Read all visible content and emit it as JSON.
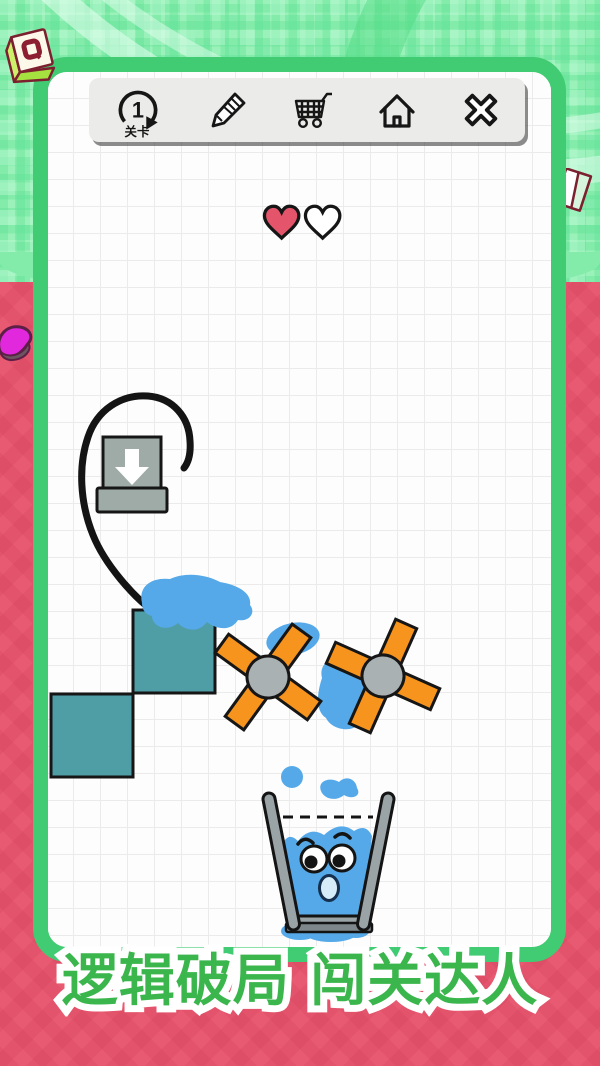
{
  "toolbar": {
    "level": {
      "number": "1",
      "label": "关卡"
    },
    "icons": [
      {
        "name": "level-restart-icon",
        "glyph": "circular-arrow"
      },
      {
        "name": "pencil-icon",
        "glyph": "pencil"
      },
      {
        "name": "shop-cart-icon",
        "glyph": "shopping-cart"
      },
      {
        "name": "home-icon",
        "glyph": "house"
      },
      {
        "name": "close-icon",
        "glyph": "cross"
      }
    ]
  },
  "lives": {
    "filled": 1,
    "total": 2
  },
  "banner": {
    "text": "逻辑破局 闯关达人"
  },
  "game_objects": [
    {
      "name": "ink-line",
      "type": "player-drawn-line"
    },
    {
      "name": "water-dispenser",
      "type": "spout-with-down-arrow"
    },
    {
      "name": "teal-block",
      "count": 2
    },
    {
      "name": "pinwheel",
      "count": 2
    },
    {
      "name": "water-splash",
      "count": 6
    },
    {
      "name": "glass-character",
      "expression": "surprised",
      "fill_marker": "dashed-line"
    }
  ],
  "colors": {
    "bg_green": "#84ecaa",
    "bg_pink": "#e85a71",
    "frame_green": "#41cc73",
    "banner_green": "#3bb64d",
    "ui_gray": "#ebebe9",
    "water_blue": "#55a9e8",
    "block_teal": "#4f9da5",
    "pinwheel_orange": "#f7941e",
    "heart_red": "#e4546a",
    "metal_gray": "#9faba7"
  }
}
